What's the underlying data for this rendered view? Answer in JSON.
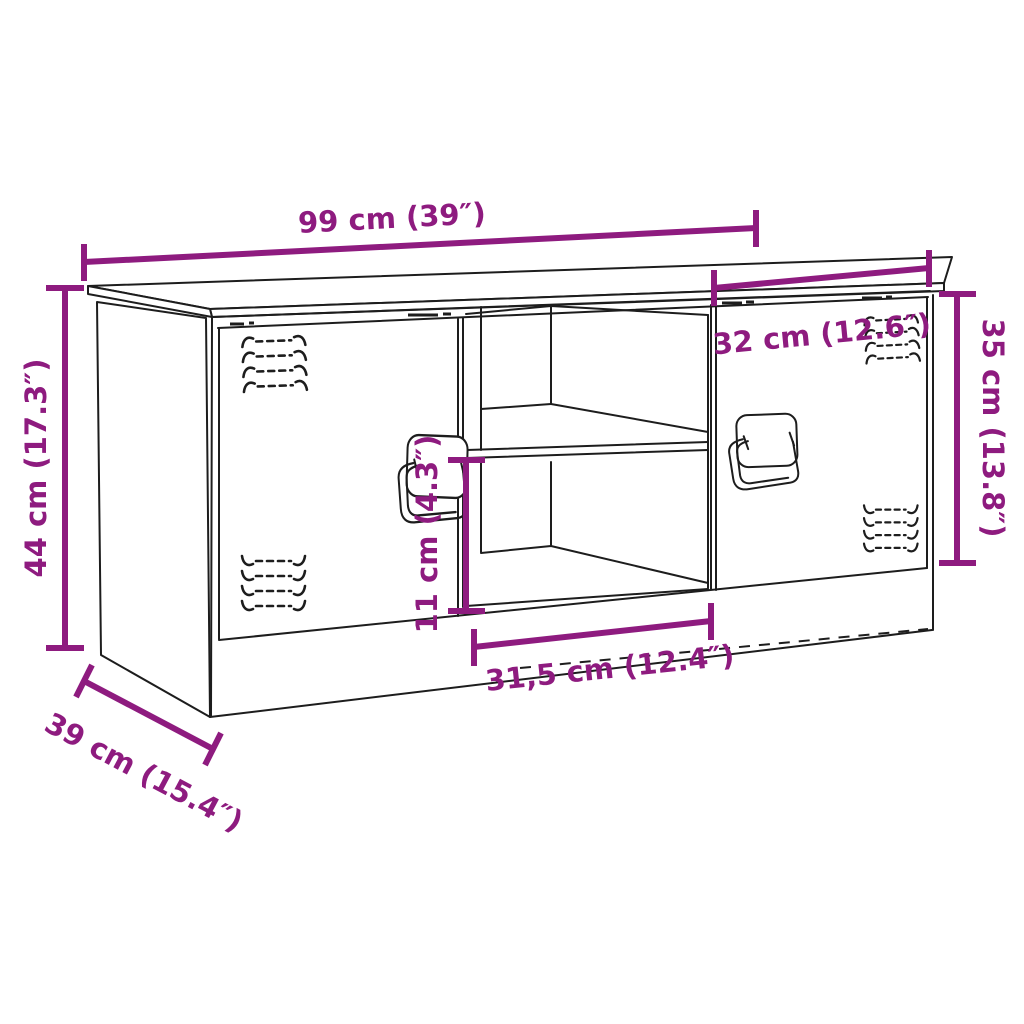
{
  "diagram": {
    "subject": "TV cabinet line drawing with two doors, open middle shelf compartment, ventilation grilles and swing handles",
    "style": {
      "background": "#ffffff",
      "line_color": "#1d1d1d",
      "dimension_color": "#8e1b7f"
    },
    "dimensions": {
      "overall_width": {
        "label": "99 cm (39″)",
        "cm": "99",
        "inch": "39"
      },
      "right_door_width": {
        "label": "32 cm (12.6″)",
        "cm": "32",
        "inch": "12.6"
      },
      "right_door_height": {
        "label": "35 cm (13.8″)",
        "cm": "35",
        "inch": "13.8"
      },
      "overall_height": {
        "label": "44 cm (17.3″)",
        "cm": "44",
        "inch": "17.3"
      },
      "shelf_opening_height": {
        "label": "11 cm (4.3″)",
        "cm": "11",
        "inch": "4.3"
      },
      "open_compartment_width": {
        "label": "31,5 cm (12.4″)",
        "cm": "31,5",
        "inch": "12.4"
      },
      "depth": {
        "label": "39 cm (15.4″)",
        "cm": "39",
        "inch": "15.4"
      }
    }
  }
}
